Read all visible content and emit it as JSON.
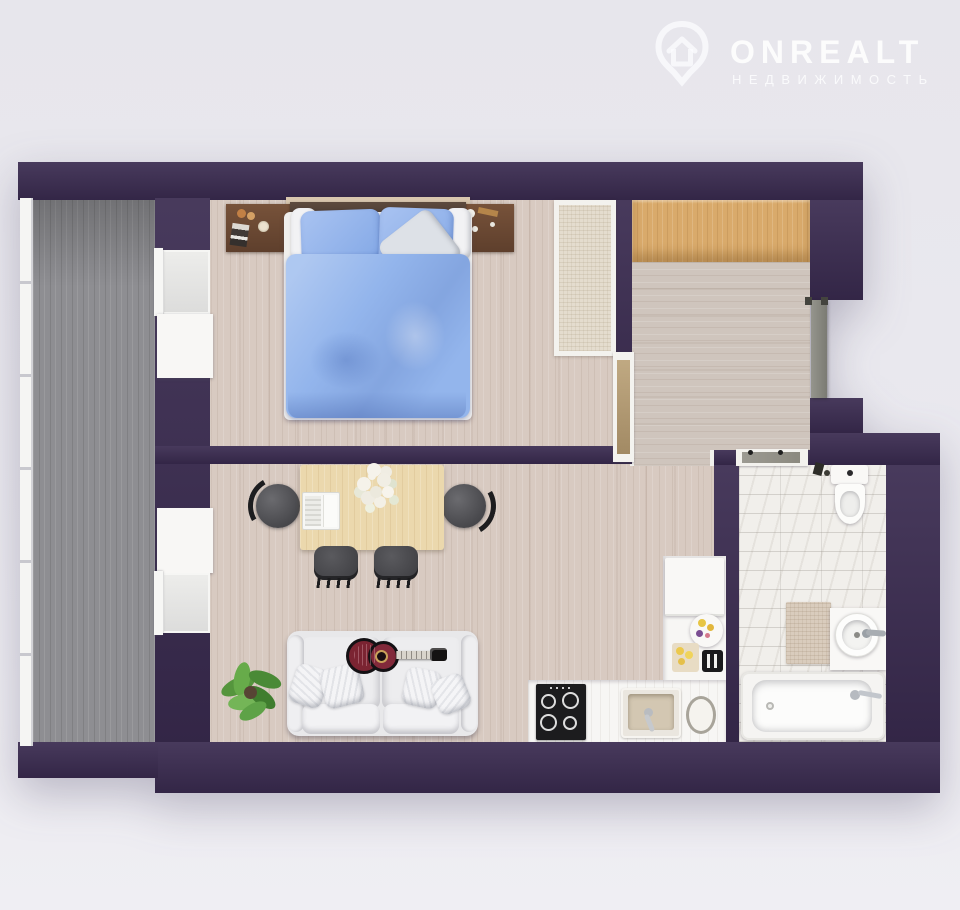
{
  "brand": {
    "name": "ONREALT",
    "tagline": "НЕДВИЖИМОСТЬ",
    "icon": "house-pin-icon"
  },
  "palette": {
    "background": "#e9e8ee",
    "wall": "#3a2b50",
    "wood_floor": "#d8cac1",
    "hall_floor": "#cfc5bd",
    "balcony_floor": "#8e8e92",
    "oak": "#d9aa6b",
    "marble": "#f1efeb",
    "bed_blue": "#93b5ec",
    "sofa": "#e8e8ea",
    "table_wood": "#ebd8ad",
    "guitar_body": "#7b2432",
    "plant_green": "#55953d",
    "entry_door": "#8a8a80",
    "interior_door": "#b29a76",
    "counter": "#f7f6f4",
    "cooktop": "#1c1c1e",
    "logo": "#ffffff"
  },
  "floorplan": {
    "style": "3d-top-down-apartment-render",
    "rooms": [
      {
        "name": "balcony",
        "floor": "gray-decking",
        "furniture": []
      },
      {
        "name": "bedroom",
        "floor": "light-wood",
        "furniture": [
          "double-bed",
          "nightstand-left",
          "nightstand-right",
          "headboard",
          "rug"
        ]
      },
      {
        "name": "hallway",
        "floor": "light-wood",
        "furniture": [
          "wardrobe"
        ]
      },
      {
        "name": "living-room-kitchen",
        "floor": "light-wood",
        "furniture": [
          "dining-table",
          "dining-chairs",
          "laptop",
          "flower-centerpiece",
          "sofa",
          "throw-pillows",
          "acoustic-guitar",
          "potted-plant",
          "fridge",
          "kitchen-counter",
          "cooktop",
          "kitchen-sink",
          "cutting-board",
          "fruit-plate",
          "toaster"
        ]
      },
      {
        "name": "bathroom",
        "floor": "marble-tile",
        "furniture": [
          "toilet",
          "vanity-with-vessel-sink",
          "bathtub",
          "bath-mat"
        ]
      }
    ],
    "doors": [
      "entry-door",
      "bedroom-door",
      "bathroom-door"
    ],
    "windows": [
      "balcony-glazing",
      "bedroom-balcony-window",
      "living-room-balcony-window"
    ]
  }
}
